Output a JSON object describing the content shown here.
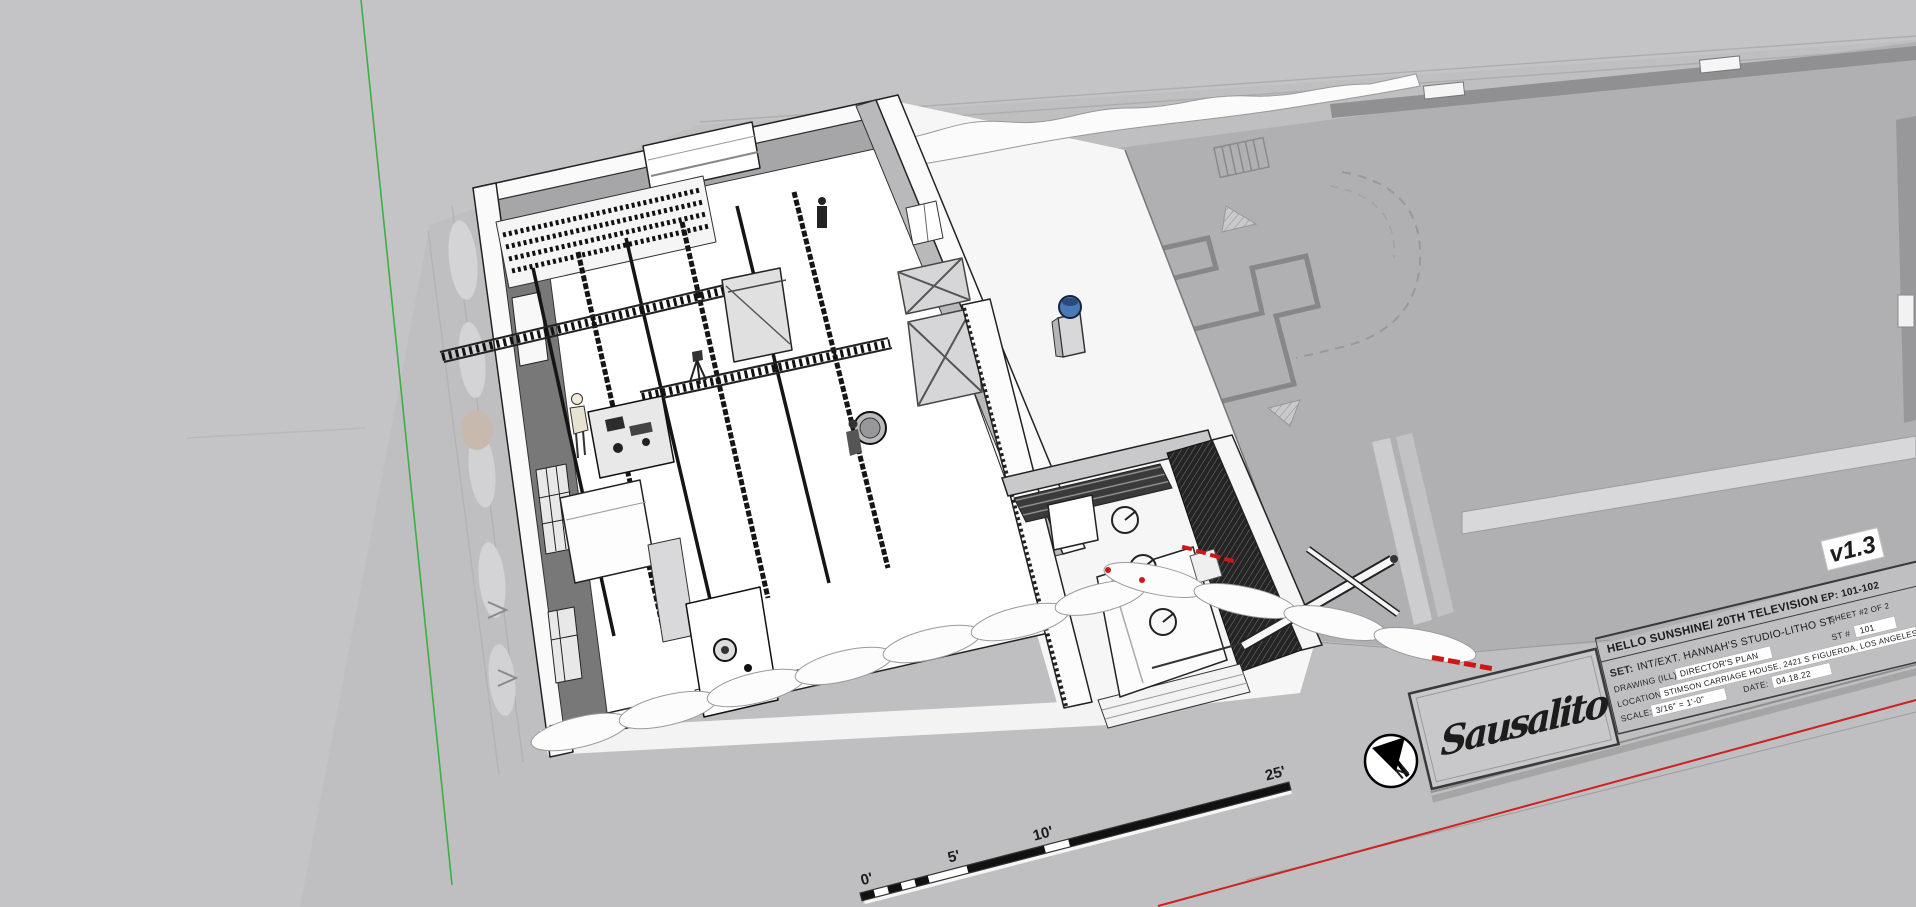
{
  "viewport": {
    "app": "3d-model-viewport"
  },
  "colors": {
    "background": "#c4c4c6",
    "sheet": "#bfbfc1",
    "stage_gray": "#b0b0b2",
    "axis_green": "#3cb043",
    "axis_red": "#cc2222",
    "version_red": "#e01010",
    "blue_prop": "#4a7ab5"
  },
  "title_block": {
    "version_tag": "v1.3",
    "production": "HELLO SUNSHINE/ 20TH TELEVISION",
    "episode": "EP: 101-102",
    "set_label": "SET:",
    "set_value": "INT/EXT. HANNAH'S STUDIO-LITHO ST.",
    "sheet": "SHEET #2 OF 2",
    "drawing_label": "DRAWING (ILL):",
    "drawing_value": "DIRECTOR'S PLAN",
    "stage_label": "ST #",
    "stage_value": "101",
    "location_label": "LOCATION:",
    "location_value": "STIMSON CARRIAGE HOUSE, 2421 S FIGUEROA, LOS ANGELES, CA",
    "scale_label": "SCALE:",
    "scale_value": "3/16\" = 1'-0\"",
    "date_label": "DATE:",
    "date_value": "04.18.22",
    "logo_text": "Sausalito"
  },
  "scale_bar": {
    "labels": [
      "0'",
      "5'",
      "10'",
      "25'"
    ]
  },
  "north_arrow": {
    "label": "N"
  }
}
